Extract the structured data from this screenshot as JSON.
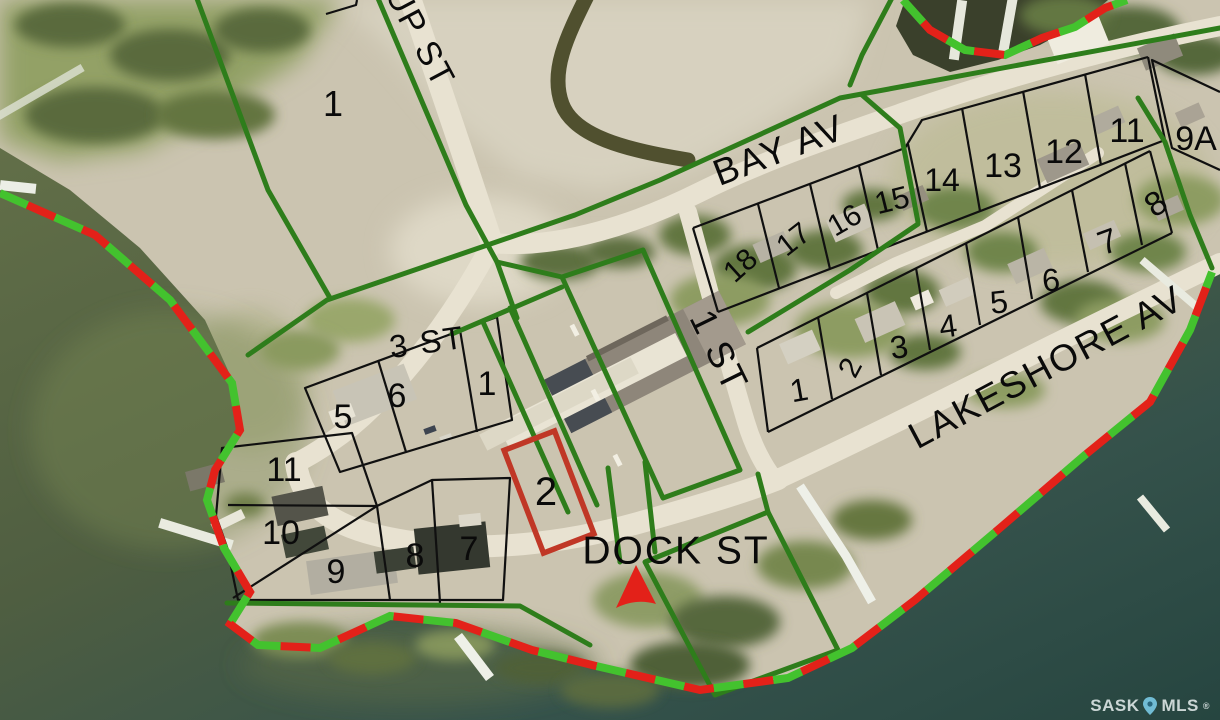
{
  "streets": [
    {
      "id": "up-st",
      "text": "UP ST",
      "x": 420,
      "y": 37,
      "rot": 62,
      "size": 34
    },
    {
      "id": "bay-av",
      "text": "BAY AV",
      "x": 779,
      "y": 150,
      "rot": -21,
      "size": 37
    },
    {
      "id": "3-st",
      "text": "3 ST",
      "x": 427,
      "y": 342,
      "rot": -8,
      "size": 32
    },
    {
      "id": "1-st",
      "text": "1 ST",
      "x": 719,
      "y": 351,
      "rot": 64,
      "size": 37
    },
    {
      "id": "dock-st",
      "text": "DOCK ST",
      "x": 676,
      "y": 551,
      "rot": 0,
      "size": 39
    },
    {
      "id": "lakeshore-av",
      "text": "LAKESHORE AV",
      "x": 1046,
      "y": 367,
      "rot": -28,
      "size": 37
    }
  ],
  "lots": [
    {
      "id": "nw-1",
      "text": "1",
      "x": 333,
      "y": 104,
      "size": 36,
      "rot": 0
    },
    {
      "id": "a-5",
      "text": "5",
      "x": 343,
      "y": 417,
      "size": 34,
      "rot": 0
    },
    {
      "id": "a-6",
      "text": "6",
      "x": 397,
      "y": 396,
      "size": 34,
      "rot": 0
    },
    {
      "id": "a-1",
      "text": "1",
      "x": 487,
      "y": 384,
      "size": 34,
      "rot": 0
    },
    {
      "id": "b-11",
      "text": "11",
      "x": 284,
      "y": 470,
      "size": 34,
      "rot": 0
    },
    {
      "id": "b-10",
      "text": "10",
      "x": 281,
      "y": 533,
      "size": 34,
      "rot": 0
    },
    {
      "id": "b-9",
      "text": "9",
      "x": 336,
      "y": 572,
      "size": 34,
      "rot": 0
    },
    {
      "id": "b-8",
      "text": "8",
      "x": 415,
      "y": 556,
      "size": 34,
      "rot": 0
    },
    {
      "id": "b-7",
      "text": "7",
      "x": 469,
      "y": 549,
      "size": 34,
      "rot": 0
    },
    {
      "id": "highlight-2",
      "text": "2",
      "x": 546,
      "y": 492,
      "size": 40,
      "rot": 0
    },
    {
      "id": "r1-18",
      "text": "18",
      "x": 741,
      "y": 266,
      "size": 30,
      "rot": -42
    },
    {
      "id": "r1-17",
      "text": "17",
      "x": 794,
      "y": 240,
      "size": 30,
      "rot": -38
    },
    {
      "id": "r1-16",
      "text": "16",
      "x": 845,
      "y": 221,
      "size": 30,
      "rot": -30
    },
    {
      "id": "r1-15",
      "text": "15",
      "x": 892,
      "y": 200,
      "size": 31,
      "rot": -14
    },
    {
      "id": "r1-14",
      "text": "14",
      "x": 942,
      "y": 180,
      "size": 32,
      "rot": 0
    },
    {
      "id": "r1-13",
      "text": "13",
      "x": 1003,
      "y": 166,
      "size": 34,
      "rot": 0
    },
    {
      "id": "r1-12",
      "text": "12",
      "x": 1064,
      "y": 152,
      "size": 34,
      "rot": 0
    },
    {
      "id": "r1-11",
      "text": "11",
      "x": 1127,
      "y": 131,
      "size": 34,
      "rot": 0
    },
    {
      "id": "r1-9a",
      "text": "9A",
      "x": 1196,
      "y": 139,
      "size": 34,
      "rot": 0
    },
    {
      "id": "r2-1",
      "text": "1",
      "x": 799,
      "y": 390,
      "size": 32,
      "rot": -10
    },
    {
      "id": "r2-2",
      "text": "2",
      "x": 851,
      "y": 368,
      "size": 30,
      "rot": -62
    },
    {
      "id": "r2-3",
      "text": "3",
      "x": 899,
      "y": 347,
      "size": 32,
      "rot": -8
    },
    {
      "id": "r2-4",
      "text": "4",
      "x": 948,
      "y": 326,
      "size": 32,
      "rot": -8
    },
    {
      "id": "r2-5",
      "text": "5",
      "x": 999,
      "y": 302,
      "size": 32,
      "rot": -6
    },
    {
      "id": "r2-6",
      "text": "6",
      "x": 1051,
      "y": 280,
      "size": 32,
      "rot": -6
    },
    {
      "id": "r2-7",
      "text": "7",
      "x": 1108,
      "y": 242,
      "size": 34,
      "rot": -20
    },
    {
      "id": "r2-8",
      "text": "8",
      "x": 1156,
      "y": 204,
      "size": 34,
      "rot": -34
    }
  ],
  "watermark": {
    "sask": "SASK",
    "mls": "MLS",
    "registered": "®",
    "icon": "map-pin-icon"
  },
  "colors": {
    "parcel_green": "#2e7d1b",
    "lot_line": "#101010",
    "dash_red": "#e32119",
    "dash_green": "#43c22e",
    "highlight_red": "#c03726",
    "label": "#0a0a0a",
    "watermark_text": "#dde6e6",
    "watermark_pin": "#79c9e4"
  }
}
